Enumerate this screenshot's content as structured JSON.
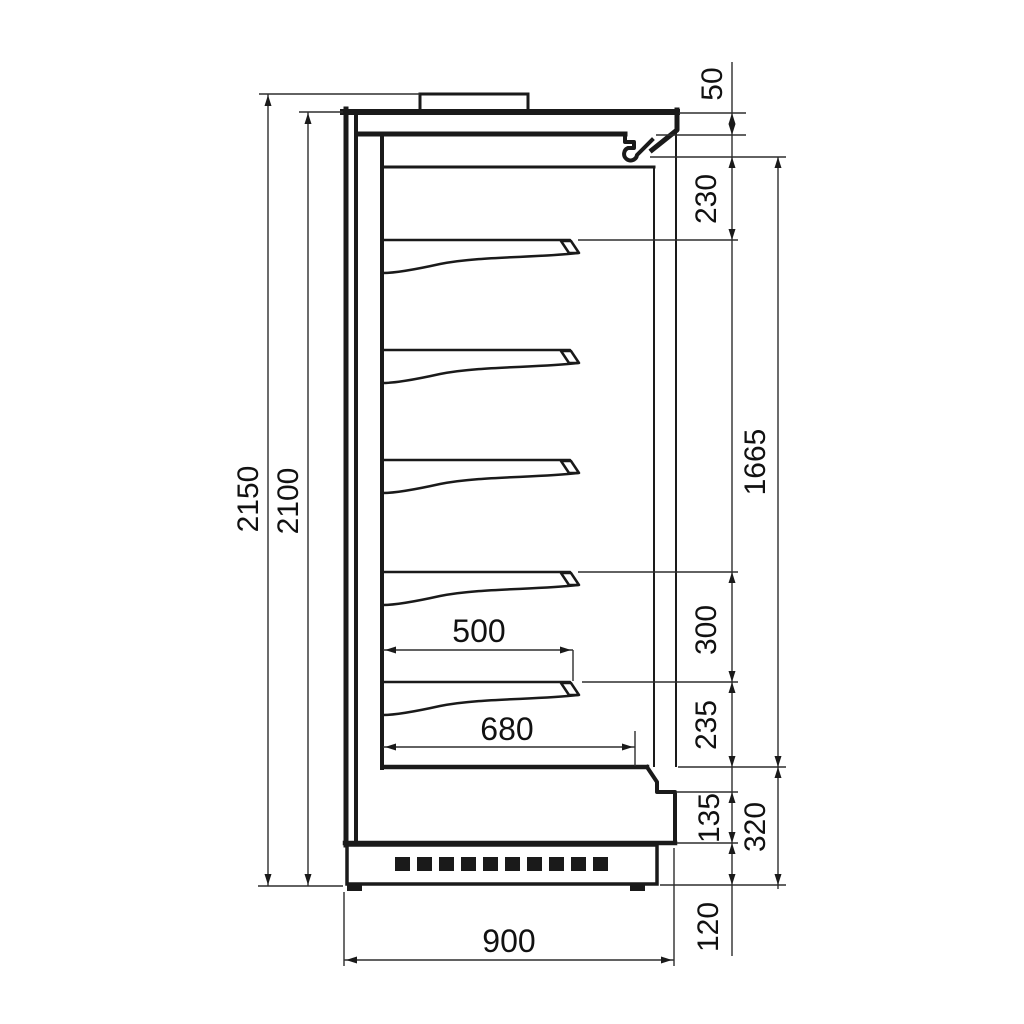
{
  "drawing": {
    "colors": {
      "line": "#1a1a1a",
      "thin_line": "#2e2e2e",
      "background": "#ffffff"
    },
    "dims": {
      "total_height": "2150",
      "cabinet_height": "2100",
      "top_panel": "50",
      "top_section": "230",
      "opening_height": "1665",
      "shelf_spacing": "300",
      "bottom_section": "235",
      "kick_height": "135",
      "base_height": "320",
      "plinth_height": "120",
      "depth": "900",
      "shelf_depth": "500",
      "deck_depth": "680"
    }
  }
}
